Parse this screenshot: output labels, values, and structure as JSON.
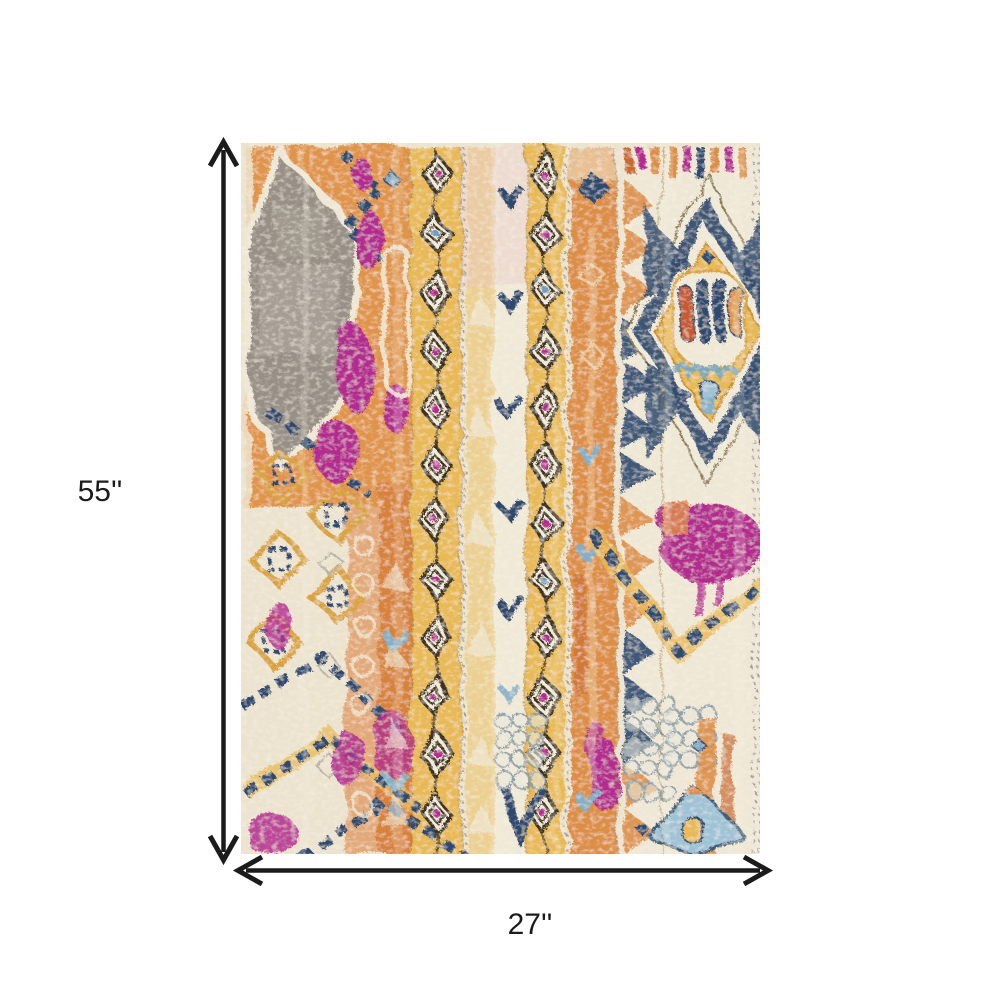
{
  "figure": {
    "type": "product-dimension-diagram",
    "subject": "distressed-bohemian-medallion-area-rug"
  },
  "dimensions": {
    "height": {
      "label": "55''"
    },
    "width": {
      "label": "27''"
    }
  },
  "style": {
    "background": "#ffffff",
    "annotation_color": "#1b1b1b",
    "rug_palette": {
      "cream": "#ece3cf",
      "gold": "#e8b954",
      "pale_gold": "#ecd092",
      "orange": "#dd8e44",
      "rust": "#c96a2f",
      "magenta": "#b42b90",
      "navy": "#2f4a70",
      "steel_blue": "#86aec6",
      "gray": "#989086"
    }
  }
}
